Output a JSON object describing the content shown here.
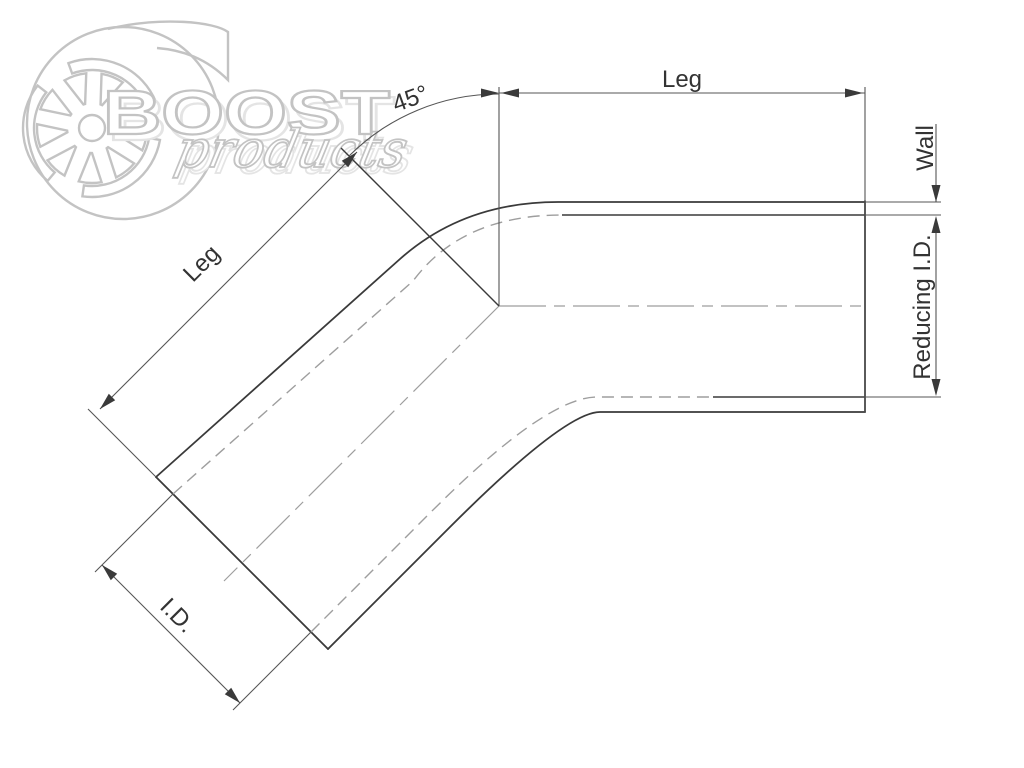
{
  "page": {
    "width": 1024,
    "height": 768,
    "background": "#ffffff"
  },
  "watermark": {
    "brand": "BOOST",
    "brand_script": "products",
    "outline_color": "#c3c3c3",
    "shadow_color": "#e4e4e4"
  },
  "drawing": {
    "type": "technical-dimension-drawing",
    "subject": "45-degree reducing elbow",
    "labels": {
      "leg_top": "Leg",
      "leg_diagonal": "Leg",
      "angle": "45°",
      "wall": "Wall",
      "reducing_id": "Reducing I.D.",
      "inner_diameter": "I.D."
    },
    "colors": {
      "outline": "#3a3a3a",
      "dimension": "#555555",
      "hidden": "#9e9e9e",
      "centerline": "#9e9e9e",
      "label": "#333333"
    }
  }
}
